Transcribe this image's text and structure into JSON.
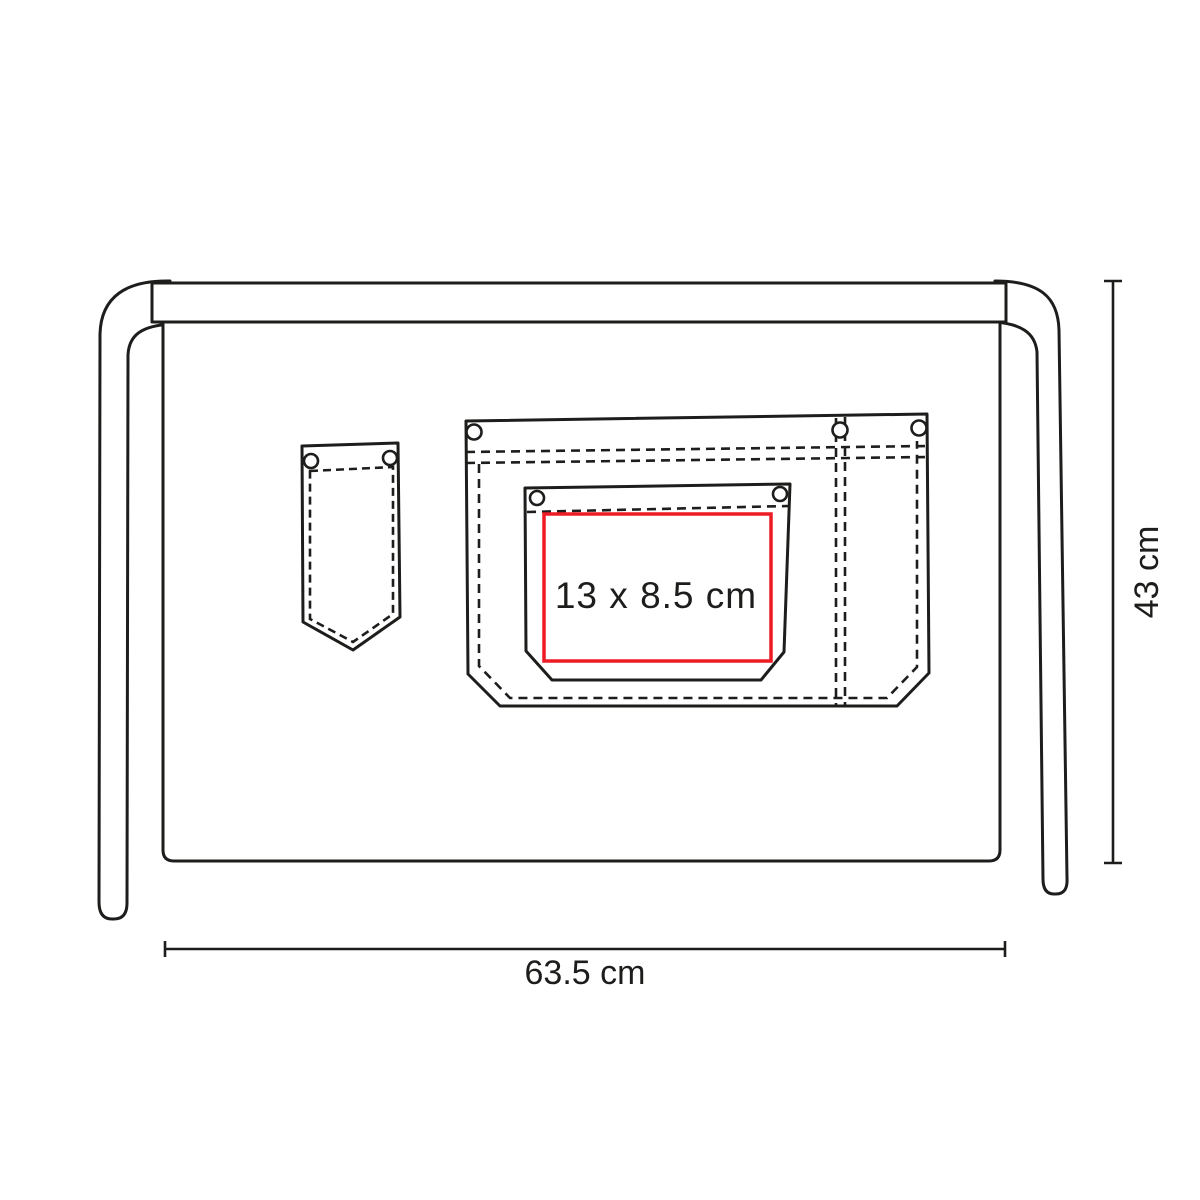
{
  "drawing": {
    "print_area": {
      "label": "13 x 8.5 cm",
      "color": "#ed1c24"
    },
    "dimensions": {
      "width": {
        "label": "63.5 cm"
      },
      "height": {
        "label": "43 cm"
      }
    },
    "colors": {
      "outline": "#1d1d1b",
      "print_area_stroke": "#ed1c24",
      "label_text": "#1d1d1b",
      "background": "#ffffff"
    }
  }
}
